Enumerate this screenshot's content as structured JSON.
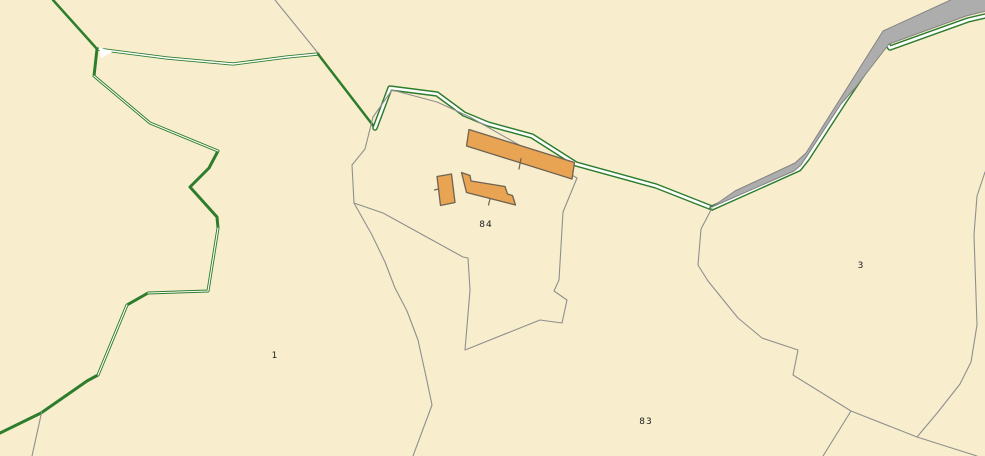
{
  "map": {
    "title": "Cadastral parcel map",
    "background_color": "#f8eecd",
    "colors": {
      "parcel_boundary_gray": "#8f8f8f",
      "hedge_green": "#2d7d2d",
      "road_fill": "#adadad",
      "road_edge": "#838383",
      "path_core_white": "#ffffff",
      "building_fill": "#e8a452",
      "building_outline": "#6f6352",
      "label_text": "#1b1b1b"
    },
    "parcel_labels": {
      "parcel_1": "1",
      "parcel_84": "84",
      "parcel_83": "83",
      "parcel_3": "3"
    },
    "features": {
      "buildings": "3 orange buildings on parcel 84 (long barn, main house, small outbuilding)",
      "road": "gray road band running from top-right corner to its end point mid-map",
      "hedges": "dark green double-line field boundaries on left and along path"
    }
  }
}
